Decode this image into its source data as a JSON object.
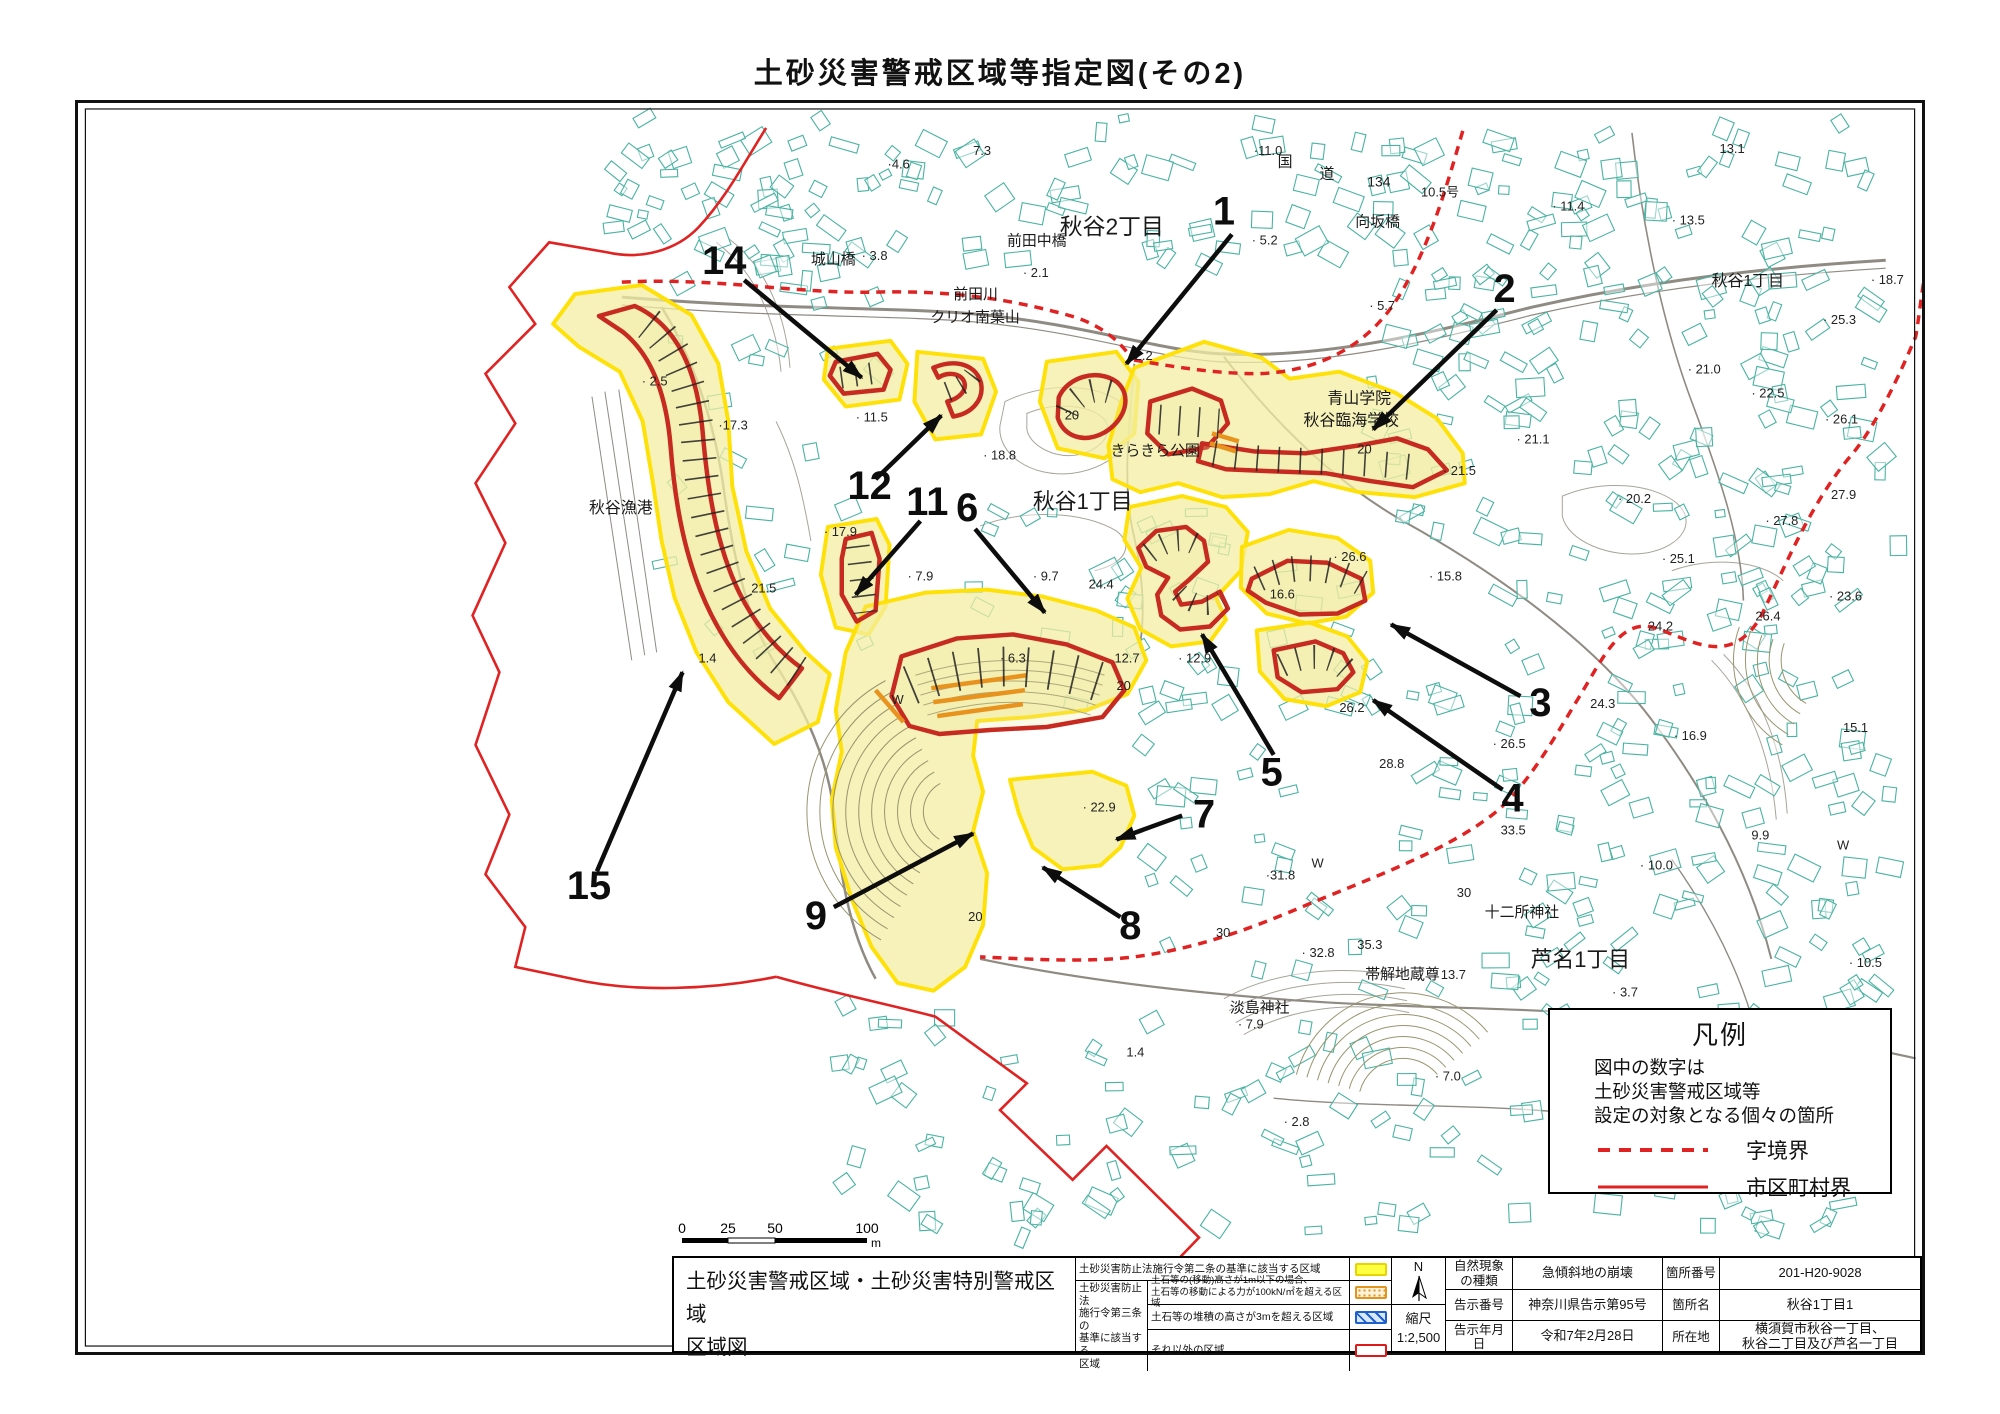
{
  "page": {
    "title": "土砂災害警戒区域等指定図(その2)"
  },
  "scale_bar": {
    "ticks": [
      "0",
      "25",
      "50",
      "100"
    ],
    "unit": "m"
  },
  "legend_box": {
    "title": "凡例",
    "note_lines": [
      "図中の数字は",
      "土砂災害警戒区域等",
      "設定の対象となる個々の箇所"
    ],
    "items": [
      {
        "style": "dashed",
        "label": "字境界"
      },
      {
        "style": "solid",
        "label": "市区町村界"
      }
    ]
  },
  "info_table": {
    "map_title_lines": [
      "土砂災害警戒区域・土砂災害特別警戒区域",
      "区域図"
    ],
    "zone_legend": {
      "row1_desc": "土砂災害防止法施行令第二条の基準に該当する区域",
      "group_label_lines": [
        "土砂災害防止法",
        "施行令第三条の",
        "基準に該当する",
        "区域"
      ],
      "row2_desc_lines": [
        "土石等の(移動)高さが1m以下の場合、",
        "土石等の移動による力が100kN/㎡を超える区域"
      ],
      "row3_desc": "土石等の堆積の高さが3mを超える区域",
      "row4_desc": "それ以外の区域"
    },
    "compass_label": "N",
    "scale_label": "縮尺",
    "scale_value": "1:2,500",
    "details": {
      "r1k1_lines": [
        "自然現象",
        "の種類"
      ],
      "r1v1": "急傾斜地の崩壊",
      "r1k2": "箇所番号",
      "r1v2": "201-H20-9028",
      "r2k1": "告示番号",
      "r2v1": "神奈川県告示第95号",
      "r2k2": "箇所名",
      "r2v2": "秋谷1丁目1",
      "r3k1": "告示年月日",
      "r3v1": "令和7年2月28日",
      "r3k2": "所在地",
      "r3v2_lines": [
        "横須賀市秋谷一丁目、",
        "秋谷二丁目及び芦名一丁目"
      ]
    }
  },
  "colors": {
    "warning_yellow_border": "#ffe10a",
    "warning_yellow_fill": "#f3eda2",
    "special_red": "#c62a20",
    "boundary_red": "#e02222",
    "building_teal": "#49b3a2",
    "orange_hatch": "#e8931e"
  },
  "map": {
    "place_labels": [
      {
        "t": "秋谷2丁目",
        "x": 985,
        "y": 132,
        "s": 23
      },
      {
        "t": "前田中橋",
        "x": 932,
        "y": 143,
        "s": 15
      },
      {
        "t": "城山橋",
        "x": 735,
        "y": 162,
        "s": 15
      },
      {
        "t": "前田川",
        "x": 878,
        "y": 197,
        "s": 15
      },
      {
        "t": "クリオ南葉山",
        "x": 855,
        "y": 220,
        "s": 15
      },
      {
        "t": "向坂橋",
        "x": 1282,
        "y": 124,
        "s": 15
      },
      {
        "t": "国",
        "x": 1204,
        "y": 64,
        "s": 15
      },
      {
        "t": "道",
        "x": 1246,
        "y": 76,
        "s": 15
      },
      {
        "t": "134",
        "x": 1294,
        "y": 84,
        "s": 14
      },
      {
        "t": "秋谷1丁目",
        "x": 1640,
        "y": 184,
        "s": 16
      },
      {
        "t": "きらきら公園",
        "x": 1036,
        "y": 354,
        "s": 15
      },
      {
        "t": "青山学院",
        "x": 1254,
        "y": 302,
        "s": 16
      },
      {
        "t": "秋谷臨海学校",
        "x": 1230,
        "y": 324,
        "s": 16
      },
      {
        "t": "秋谷1丁目",
        "x": 958,
        "y": 408,
        "s": 22
      },
      {
        "t": "秋谷漁港",
        "x": 512,
        "y": 412,
        "s": 16
      },
      {
        "t": "十二所神社",
        "x": 1412,
        "y": 818,
        "s": 15
      },
      {
        "t": "芦名1丁目",
        "x": 1458,
        "y": 868,
        "s": 22
      },
      {
        "t": "帯解地蔵尊",
        "x": 1292,
        "y": 880,
        "s": 15
      },
      {
        "t": "淡島神社",
        "x": 1156,
        "y": 914,
        "s": 15
      }
    ],
    "elevation_labels": [
      {
        "t": "·4.6",
        "x": 812,
        "y": 66
      },
      {
        "t": "7.3",
        "x": 898,
        "y": 52
      },
      {
        "t": "· 3.8",
        "x": 786,
        "y": 158
      },
      {
        "t": "· 2.1",
        "x": 948,
        "y": 175
      },
      {
        "t": "·2.2",
        "x": 1056,
        "y": 258
      },
      {
        "t": "·11.0",
        "x": 1180,
        "y": 52
      },
      {
        "t": "10.5号",
        "x": 1348,
        "y": 94
      },
      {
        "t": "· 5.2",
        "x": 1178,
        "y": 142
      },
      {
        "t": "· 11.4",
        "x": 1480,
        "y": 108
      },
      {
        "t": "· 13.5",
        "x": 1600,
        "y": 122
      },
      {
        "t": "13.1",
        "x": 1648,
        "y": 50
      },
      {
        "t": "· 5.7",
        "x": 1296,
        "y": 208
      },
      {
        "t": "· 18.7",
        "x": 1800,
        "y": 182
      },
      {
        "t": "· 25.3",
        "x": 1752,
        "y": 222
      },
      {
        "t": "· 21.0",
        "x": 1616,
        "y": 272
      },
      {
        "t": "· 22.5",
        "x": 1680,
        "y": 296
      },
      {
        "t": "· 26.1",
        "x": 1754,
        "y": 322
      },
      {
        "t": "27.9",
        "x": 1760,
        "y": 398
      },
      {
        "t": "· 27.8",
        "x": 1694,
        "y": 424
      },
      {
        "t": "· 23.6",
        "x": 1758,
        "y": 500
      },
      {
        "t": "26.4",
        "x": 1684,
        "y": 520
      },
      {
        "t": "· 25.1",
        "x": 1590,
        "y": 462
      },
      {
        "t": "· 20.2",
        "x": 1546,
        "y": 402
      },
      {
        "t": "· 15.8",
        "x": 1356,
        "y": 480
      },
      {
        "t": "24.2",
        "x": 1576,
        "y": 530
      },
      {
        "t": "24.3",
        "x": 1518,
        "y": 608
      },
      {
        "t": "· 26.5",
        "x": 1420,
        "y": 648
      },
      {
        "t": "28.8",
        "x": 1306,
        "y": 668
      },
      {
        "t": "· 16.9",
        "x": 1602,
        "y": 640
      },
      {
        "t": "15.1",
        "x": 1772,
        "y": 632
      },
      {
        "t": "· 2.5",
        "x": 565,
        "y": 284
      },
      {
        "t": "·17.3",
        "x": 642,
        "y": 328
      },
      {
        "t": "· 11.5",
        "x": 780,
        "y": 320
      },
      {
        "t": "· 17.9",
        "x": 748,
        "y": 435
      },
      {
        "t": "21.5",
        "x": 675,
        "y": 492
      },
      {
        "t": "· 7.9",
        "x": 832,
        "y": 480
      },
      {
        "t": "· 18.8",
        "x": 908,
        "y": 358
      },
      {
        "t": "· 9.7",
        "x": 958,
        "y": 480
      },
      {
        "t": "24.4",
        "x": 1014,
        "y": 488
      },
      {
        "t": "· 6.3",
        "x": 925,
        "y": 562
      },
      {
        "t": "12.7",
        "x": 1040,
        "y": 562
      },
      {
        "t": "· 12.9",
        "x": 1104,
        "y": 562
      },
      {
        "t": "20",
        "x": 1042,
        "y": 590
      },
      {
        "t": "26.2",
        "x": 1266,
        "y": 612
      },
      {
        "t": "· 22.9",
        "x": 1008,
        "y": 712
      },
      {
        "t": "·31.8",
        "x": 1192,
        "y": 780
      },
      {
        "t": "W",
        "x": 1238,
        "y": 768
      },
      {
        "t": "16.6",
        "x": 1196,
        "y": 498
      },
      {
        "t": "· 26.6",
        "x": 1260,
        "y": 460
      },
      {
        "t": "· 21.5",
        "x": 1370,
        "y": 374
      },
      {
        "t": "· 21.1",
        "x": 1444,
        "y": 342
      },
      {
        "t": "30",
        "x": 1142,
        "y": 838
      },
      {
        "t": "30",
        "x": 1384,
        "y": 798
      },
      {
        "t": "· 32.8",
        "x": 1228,
        "y": 858
      },
      {
        "t": "35.3",
        "x": 1284,
        "y": 850
      },
      {
        "t": "33.5",
        "x": 1428,
        "y": 735
      },
      {
        "t": "9.9",
        "x": 1680,
        "y": 740
      },
      {
        "t": "W",
        "x": 1766,
        "y": 750
      },
      {
        "t": "· 13.7",
        "x": 1360,
        "y": 880
      },
      {
        "t": "· 10.0",
        "x": 1568,
        "y": 770
      },
      {
        "t": "· 10.5",
        "x": 1778,
        "y": 868
      },
      {
        "t": "· 3.7",
        "x": 1540,
        "y": 898
      },
      {
        "t": "· 7.0",
        "x": 1362,
        "y": 982
      },
      {
        "t": "· 2.8",
        "x": 1210,
        "y": 1028
      },
      {
        "t": "· 7.9",
        "x": 1164,
        "y": 930
      },
      {
        "t": "1.4",
        "x": 1052,
        "y": 958
      },
      {
        "t": "1.4",
        "x": 622,
        "y": 562
      },
      {
        "t": "· 4.1",
        "x": 1770,
        "y": 1092
      },
      {
        "t": "20",
        "x": 990,
        "y": 318
      },
      {
        "t": "20",
        "x": 1284,
        "y": 352
      },
      {
        "t": "W",
        "x": 816,
        "y": 604
      },
      {
        "t": "20",
        "x": 893,
        "y": 822
      }
    ],
    "zone_markers": [
      {
        "n": "1",
        "lx": 1150,
        "ly": 122,
        "x1": 1158,
        "y1": 132,
        "x2": 1052,
        "y2": 262
      },
      {
        "n": "2",
        "lx": 1432,
        "ly": 200,
        "x1": 1424,
        "y1": 208,
        "x2": 1300,
        "y2": 328
      },
      {
        "n": "3",
        "lx": 1468,
        "ly": 616,
        "x1": 1448,
        "y1": 596,
        "x2": 1318,
        "y2": 524
      },
      {
        "n": "4",
        "lx": 1440,
        "ly": 712,
        "x1": 1430,
        "y1": 690,
        "x2": 1300,
        "y2": 600
      },
      {
        "n": "5",
        "lx": 1198,
        "ly": 686,
        "x1": 1200,
        "y1": 655,
        "x2": 1128,
        "y2": 534
      },
      {
        "n": "6",
        "lx": 892,
        "ly": 420,
        "x1": 900,
        "y1": 428,
        "x2": 970,
        "y2": 512
      },
      {
        "n": "7",
        "lx": 1130,
        "ly": 728,
        "x1": 1108,
        "y1": 716,
        "x2": 1042,
        "y2": 740
      },
      {
        "n": "8",
        "lx": 1056,
        "ly": 840,
        "x1": 1046,
        "y1": 818,
        "x2": 968,
        "y2": 768
      },
      {
        "n": "9",
        "lx": 740,
        "ly": 830,
        "x1": 758,
        "y1": 808,
        "x2": 898,
        "y2": 734
      },
      {
        "n": "11",
        "lx": 852,
        "ly": 414,
        "x1": 845,
        "y1": 420,
        "x2": 780,
        "y2": 494
      },
      {
        "n": "12",
        "lx": 794,
        "ly": 398,
        "x1": 800,
        "y1": 378,
        "x2": 866,
        "y2": 314
      },
      {
        "n": "14",
        "lx": 648,
        "ly": 172,
        "x1": 668,
        "y1": 178,
        "x2": 786,
        "y2": 276
      },
      {
        "n": "15",
        "lx": 512,
        "ly": 800,
        "x1": 520,
        "y1": 772,
        "x2": 606,
        "y2": 572
      }
    ]
  }
}
